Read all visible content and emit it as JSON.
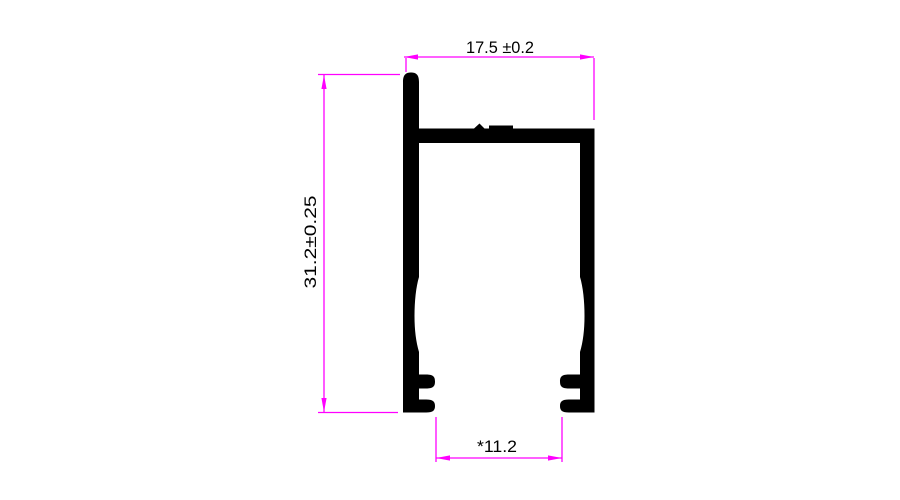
{
  "canvas": {
    "background": "#ffffff"
  },
  "profile": {
    "fill": "#000000"
  },
  "dimensions": {
    "line_color": "#ff00ff",
    "text_color": "#000000",
    "top_width": {
      "label": "17.5 ±0.2"
    },
    "left_height": {
      "label": "31.2±0.25"
    },
    "bottom_width": {
      "label": "*11.2"
    }
  }
}
